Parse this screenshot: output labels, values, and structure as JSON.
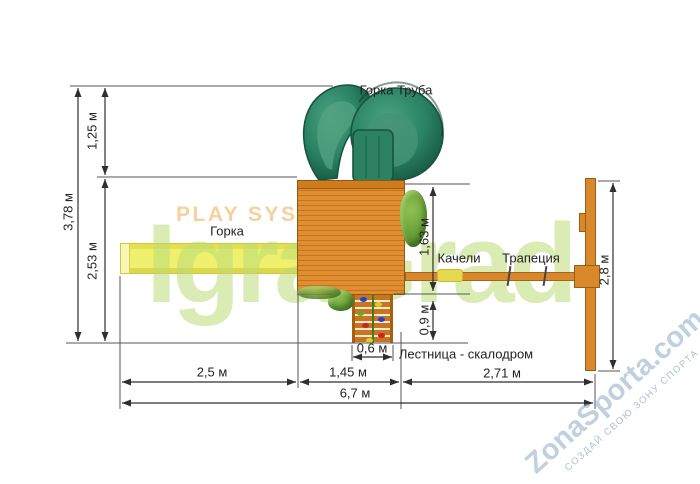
{
  "labels": {
    "tube_slide": "Горка Труба",
    "slide": "Горка",
    "swings": "Качели",
    "trapeze": "Трапеция",
    "climbing_ladder": "Лестница - скалодром"
  },
  "dimensions": {
    "total_height": "3,78 м",
    "tube_section_height": "1,25 м",
    "lower_section_height": "2,53 м",
    "platform_depth": "1,63 м",
    "ladder_depth": "0,9 м",
    "ladder_width": "0,6 м",
    "slide_length": "2,5 м",
    "platform_width": "1,45 м",
    "swing_section_length": "2,71 м",
    "total_length": "6,7 м",
    "swing_frame_width": "2,8 м"
  },
  "watermarks": {
    "play_system": "PLAY SYSTEM",
    "igragrad": "IgraGrad",
    "zonasporta": "ZonaSporta.com",
    "zonasporta_tagline": "СОЗДАЙ СВОЮ ЗОНУ СПОРТА"
  },
  "colors": {
    "wood": "#d9882b",
    "wood_dark": "#c27420",
    "slide_yellow": "#eef06e",
    "tube_green": "#2a8767",
    "bush_green": "#6ba33a",
    "dimension_line": "#2f2f2f",
    "watermark_green": "#bbdb76",
    "watermark_orange": "#f6cd98",
    "watermark_blue": "#94b1c8"
  }
}
